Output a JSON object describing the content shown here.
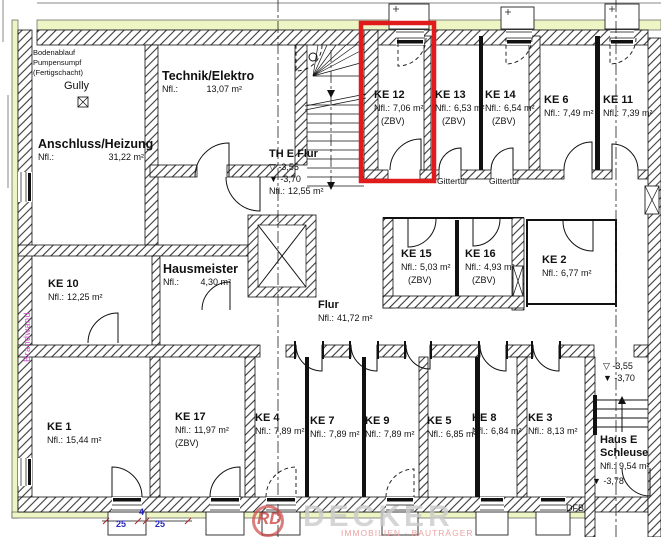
{
  "drawing_type": "basement floor plan",
  "highlight": {
    "target": "KE 12",
    "color": "#e01b1b"
  },
  "rooms": [
    {
      "name": "Anschluss/Heizung",
      "area_label": "Nfl.:",
      "area": "31,22 m²"
    },
    {
      "name": "Technik/Elektro",
      "area_label": "Nfl.:",
      "area": "13,07 m²"
    },
    {
      "name": "TH E Flur",
      "levels": [
        "▽ -3,55",
        "▼ -3,70"
      ],
      "area_label": "Nfl.:",
      "area": "12,55 m²"
    },
    {
      "name": "KE 12",
      "area_label": "Nfl.:",
      "area": "7,06 m²",
      "note": "(ZBV)",
      "highlighted": true
    },
    {
      "name": "KE 13",
      "area_label": "Nfl.:",
      "area": "6,53 m²",
      "note": "(ZBV)"
    },
    {
      "name": "KE 14",
      "area_label": "Nfl.:",
      "area": "6,54 m²",
      "note": "(ZBV)"
    },
    {
      "name": "KE 6",
      "area_label": "Nfl.:",
      "area": "7,49 m²"
    },
    {
      "name": "KE 11",
      "area_label": "Nfl.:",
      "area": "7,39 m²"
    },
    {
      "name": "KE 15",
      "area_label": "Nfl.:",
      "area": "5,03 m²",
      "note": "(ZBV)"
    },
    {
      "name": "KE 16",
      "area_label": "Nfl.:",
      "area": "4,93 m²",
      "note": "(ZBV)"
    },
    {
      "name": "KE 2",
      "area_label": "Nfl.:",
      "area": "6,77 m²"
    },
    {
      "name": "KE 10",
      "area_label": "Nfl.:",
      "area": "12,25 m²"
    },
    {
      "name": "Hausmeister",
      "area_label": "Nfl.:",
      "area": "4,30 m²"
    },
    {
      "name": "Flur",
      "area_label": "Nfl.:",
      "area": "41,72 m²"
    },
    {
      "name": "KE 1",
      "area_label": "Nfl.:",
      "area": "15,44 m²"
    },
    {
      "name": "KE 17",
      "area_label": "Nfl.:",
      "area": "11,97 m²",
      "note": "(ZBV)"
    },
    {
      "name": "KE 4",
      "area_label": "Nfl.:",
      "area": "7,89 m²"
    },
    {
      "name": "KE 7",
      "area_label": "Nfl.:",
      "area": "7,89 m²"
    },
    {
      "name": "KE 9",
      "area_label": "Nfl.:",
      "area": "7,89 m²"
    },
    {
      "name": "KE 5",
      "area_label": "Nfl.:",
      "area": "6,85 m²"
    },
    {
      "name": "KE 8",
      "area_label": "Nfl.:",
      "area": "6,84 m²"
    },
    {
      "name": "KE 3",
      "area_label": "Nfl.:",
      "area": "8,13 m²"
    },
    {
      "name_line1": "Haus E",
      "name_line2": "Schleuse",
      "area_label": "Nfl.:",
      "area": "9,54 m²",
      "levels": [
        "▽ -3,55",
        "▼ -3,70"
      ],
      "level_bottom": "▼ -3,78"
    }
  ],
  "labels": {
    "bodenablauf": [
      "Bodenablauf",
      "Pumpensumpf",
      "(Fertigschacht)"
    ],
    "gully": "Gully",
    "gittertuer": [
      "Gittertür",
      "Gittertür"
    ],
    "brandwand": "Brandwand",
    "dfb": "DFB"
  },
  "dimension_chain": {
    "left": "25",
    "middle": "4",
    "right": "25"
  },
  "watermark": {
    "monogram": "RD",
    "name": "DECKER",
    "subtitle": "IMMOBILIEN · BAUTRÄGER"
  },
  "colors": {
    "insulation_band": "#edf5c4",
    "fire_wall_text": "#c74bc7",
    "dimension_text": "#2a2ac0",
    "highlight_red": "#e01b1b",
    "watermark_gray": "#cbcbcb",
    "watermark_pink": "#eca3a3"
  }
}
